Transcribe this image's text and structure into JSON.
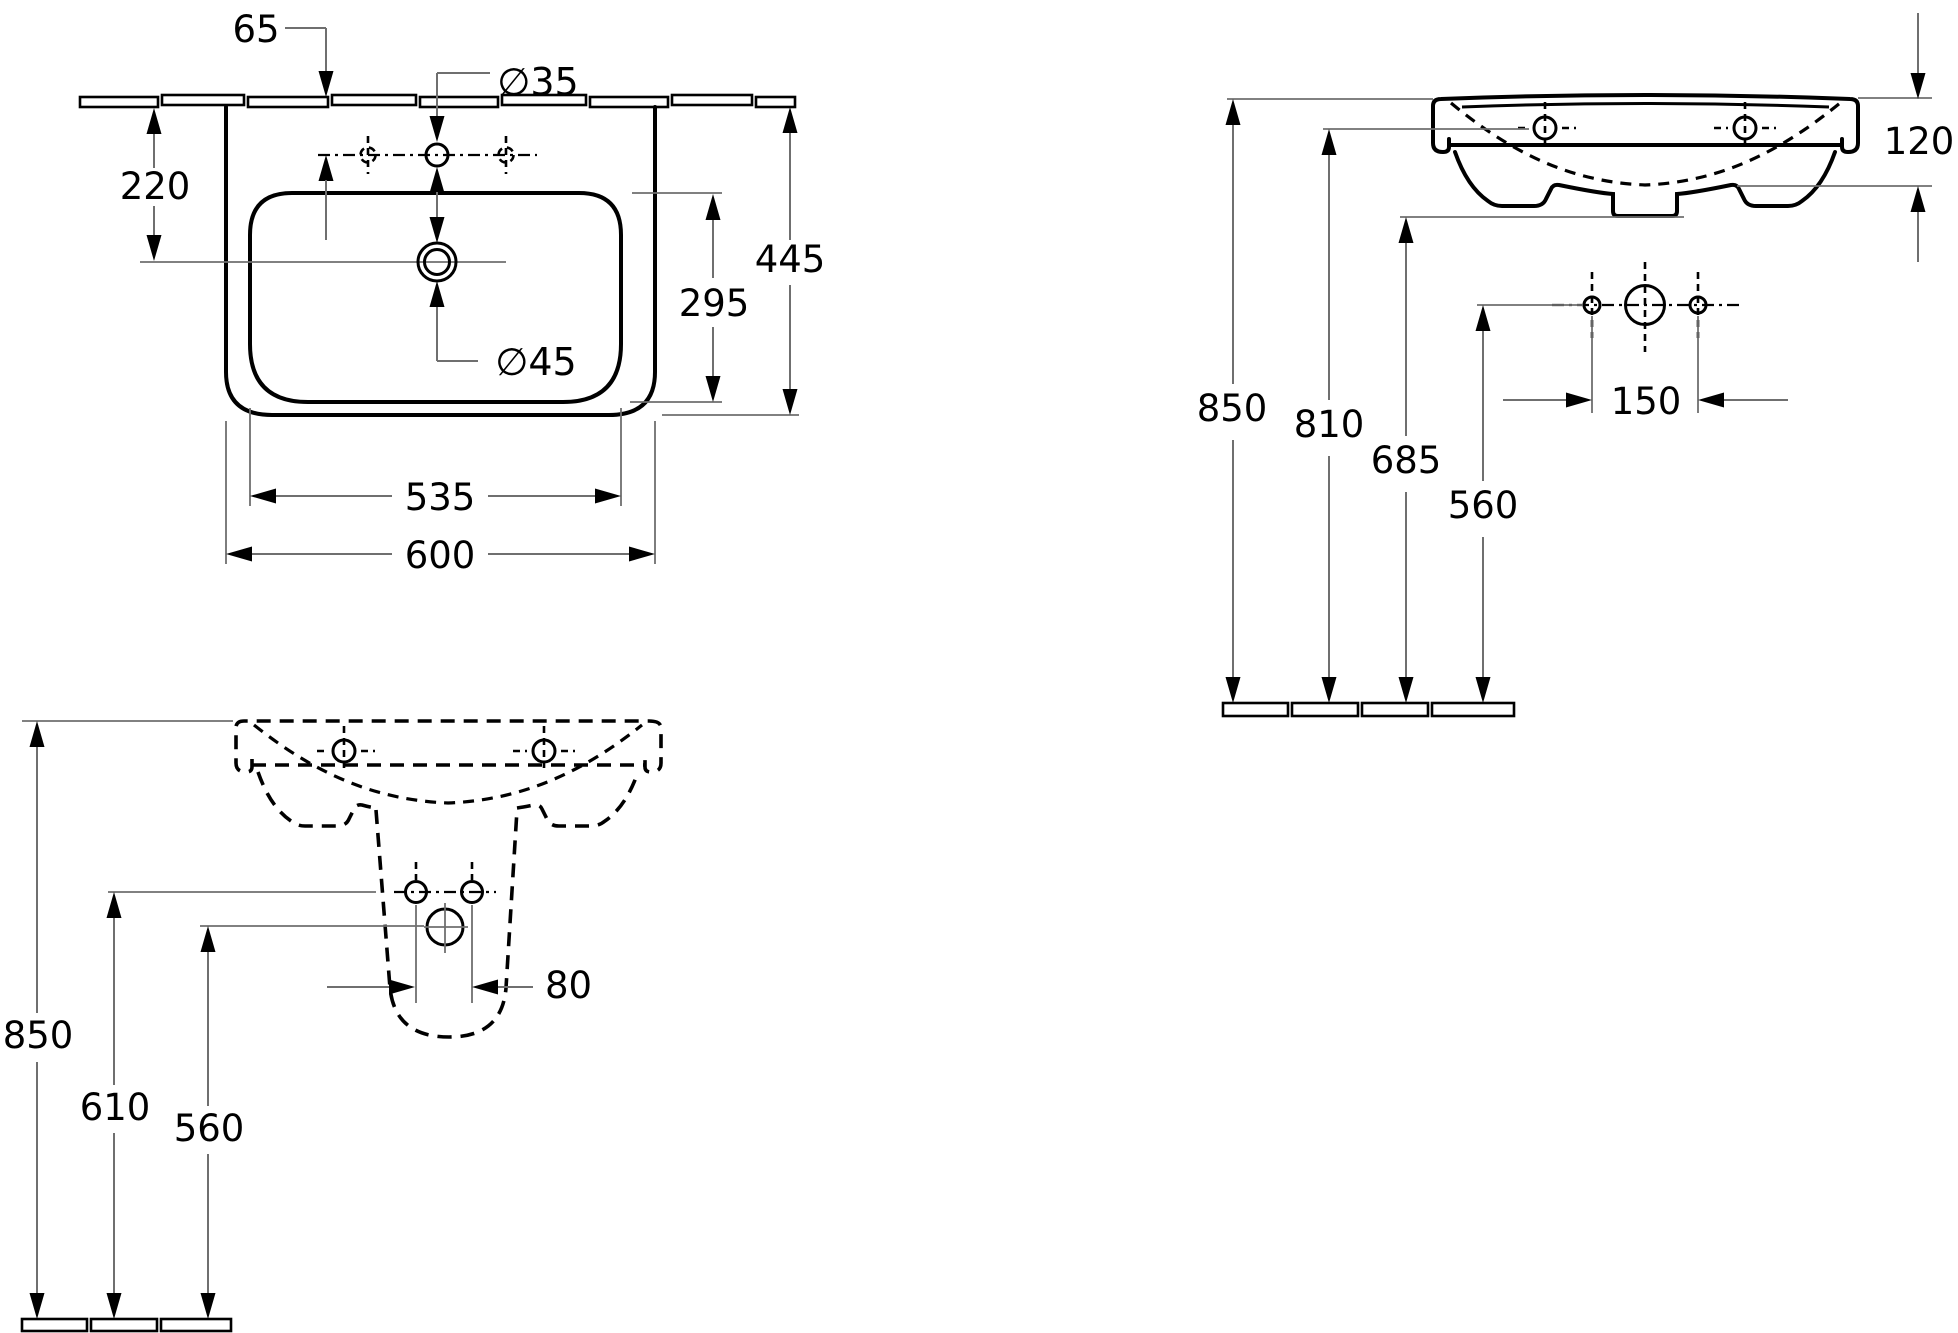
{
  "drawing": {
    "plan_view": {
      "tap_hole_offset": "65",
      "tap_hole_diameter": "∅35",
      "drain_offset": "220",
      "drain_diameter": "∅45",
      "bowl_depth": "295",
      "overall_depth": "445",
      "bowl_width": "535",
      "overall_width": "600"
    },
    "front_view": {
      "bowl_inner_depth": "120",
      "rim_height": "850",
      "fixing_hole_height": "810",
      "body_bottom_height": "685",
      "fitting_hole_height": "560",
      "fitting_hole_spacing": "150"
    },
    "installation_view": {
      "rim_height": "850",
      "bolt_hole_height": "610",
      "trap_height": "560",
      "bolt_hole_spacing": "80"
    }
  }
}
